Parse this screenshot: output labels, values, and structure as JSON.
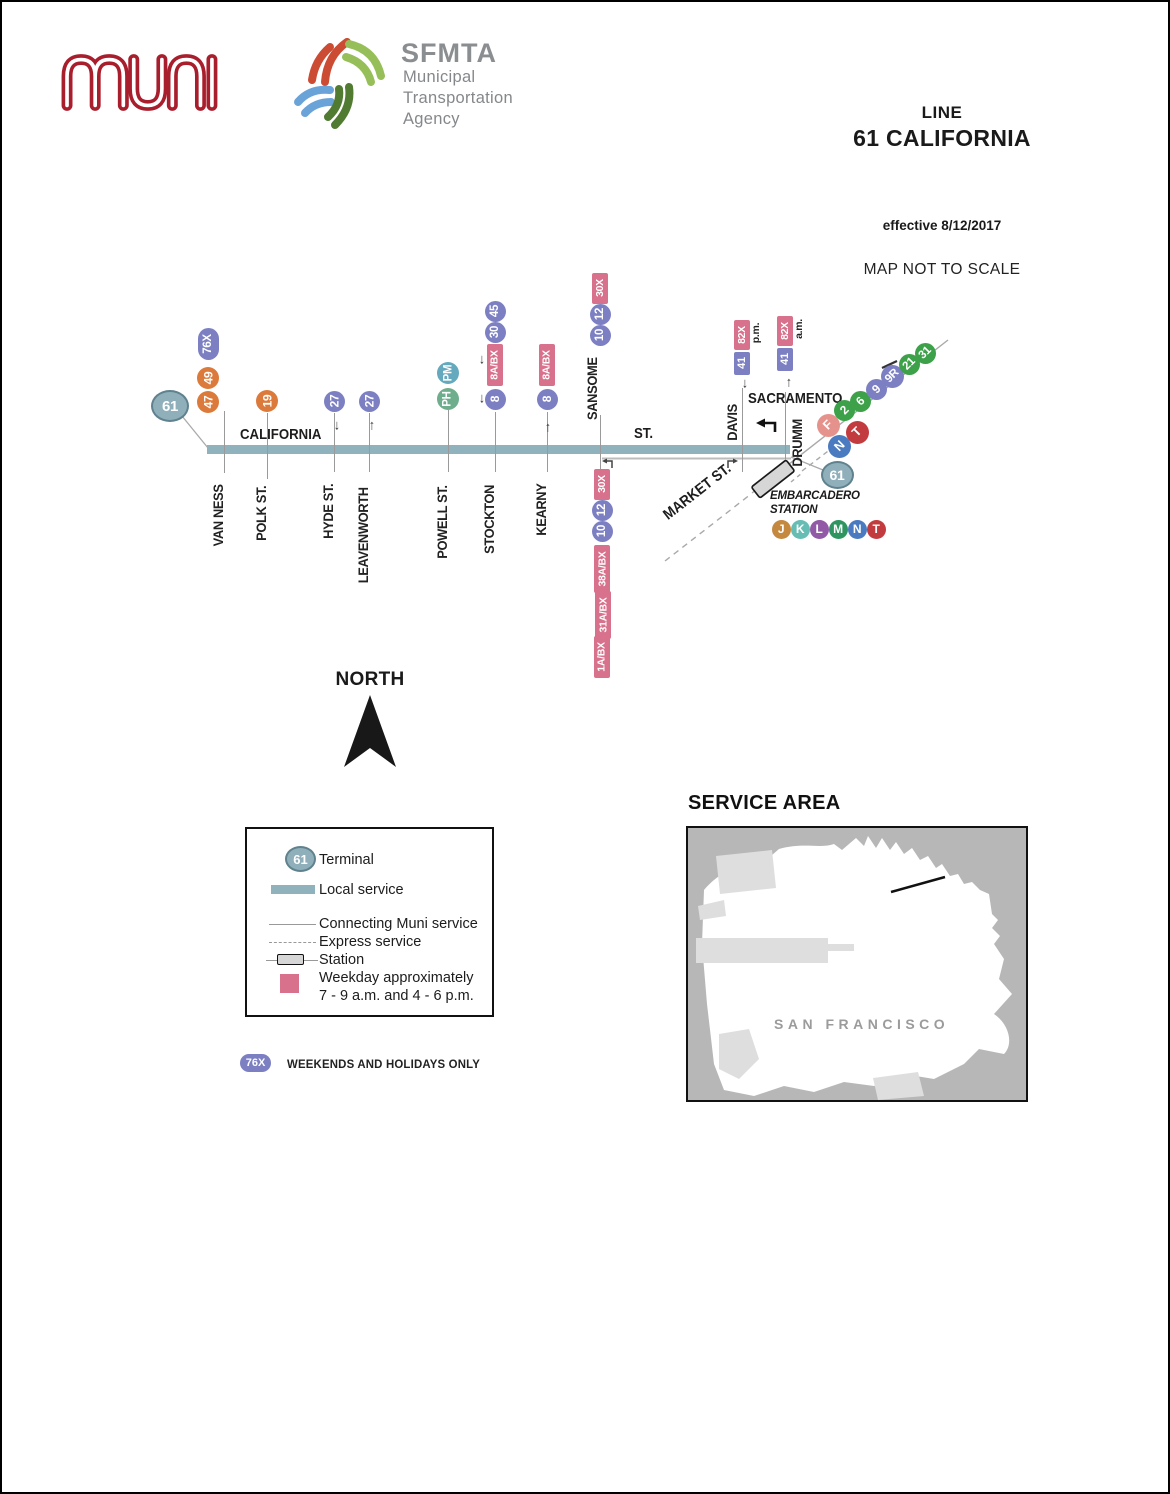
{
  "header": {
    "muni_logo": "muni",
    "sfmta": {
      "acronym": "SFMTA",
      "lines": [
        "Municipal",
        "Transportation",
        "Agency"
      ]
    },
    "line_label": "LINE",
    "line_name": "61 CALIFORNIA",
    "effective": "effective 8/12/2017",
    "scale_note": "MAP NOT TO SCALE"
  },
  "map": {
    "main_street": "CALIFORNIA",
    "main_street_suffix": "ST.",
    "cross_label_sacramento": "SACRAMENTO",
    "market_label": "MARKET ST.",
    "station_label_line1": "EMBARCADERO",
    "station_label_line2": "STATION",
    "streets": [
      {
        "label": "VAN NESS",
        "x": 222,
        "cx": 216,
        "lt": 409,
        "lb": 471,
        "ly": 477
      },
      {
        "label": "POLK ST.",
        "x": 265,
        "cx": 259,
        "lt": 411,
        "lb": 477,
        "ly": 479
      },
      {
        "label": "HYDE ST.",
        "x": 332,
        "cx": 326,
        "lt": 411,
        "lb": 470,
        "ly": 477
      },
      {
        "label": "LEAVENWORTH",
        "x": 367,
        "cx": 361,
        "lt": 411,
        "lb": 470,
        "ly": 477
      },
      {
        "label": "POWELL ST.",
        "x": 446,
        "cx": 440,
        "lt": 408,
        "lb": 470,
        "ly": 477
      },
      {
        "label": "STOCKTON",
        "x": 493,
        "cx": 487,
        "lt": 410,
        "lb": 470,
        "ly": 477
      },
      {
        "label": "KEARNY",
        "x": 545,
        "cx": 539,
        "lt": 410,
        "lb": 470,
        "ly": 477
      },
      {
        "label": "SANSOME",
        "x": 598,
        "cx": 590,
        "lt": 413,
        "lb": 470,
        "ly": 350
      },
      {
        "label": "DAVIS",
        "x": 740,
        "cx": 730,
        "lt": 386,
        "lb": 470,
        "ly": 399
      },
      {
        "label": "DRUMM",
        "x": 783,
        "cx": 795,
        "lt": 390,
        "lb": 458,
        "ly": 413
      }
    ],
    "bullets": [
      {
        "t": "61",
        "x": 168,
        "y": 404,
        "w": 38,
        "h": 32,
        "c": "terminal",
        "sh": "c",
        "r": 0,
        "fs": 15
      },
      {
        "t": "47",
        "x": 206,
        "y": 400,
        "w": 22,
        "h": 22,
        "c": "orange",
        "sh": "c",
        "r": -90,
        "fs": 12
      },
      {
        "t": "49",
        "x": 206,
        "y": 376,
        "w": 22,
        "h": 22,
        "c": "orange",
        "sh": "c",
        "r": -90,
        "fs": 12
      },
      {
        "t": "76X",
        "x": 206,
        "y": 342,
        "w": 21,
        "h": 32,
        "c": "slate",
        "sh": "p",
        "r": -90,
        "fs": 11.5
      },
      {
        "t": "19",
        "x": 265,
        "y": 399,
        "w": 22,
        "h": 22,
        "c": "orange",
        "sh": "c",
        "r": -90,
        "fs": 12
      },
      {
        "t": "27",
        "x": 332,
        "y": 399,
        "w": 21,
        "h": 21,
        "c": "slate",
        "sh": "c",
        "r": -90,
        "fs": 12
      },
      {
        "t": "27",
        "x": 367,
        "y": 399,
        "w": 21,
        "h": 21,
        "c": "slate",
        "sh": "c",
        "r": -90,
        "fs": 12
      },
      {
        "t": "PH",
        "x": 446,
        "y": 397,
        "w": 22,
        "h": 22,
        "c": "phgreen",
        "sh": "c",
        "r": -90,
        "fs": 11.5
      },
      {
        "t": "PM",
        "x": 446,
        "y": 371,
        "w": 22,
        "h": 22,
        "c": "pmteal",
        "sh": "c",
        "r": -90,
        "fs": 11.5
      },
      {
        "t": "8",
        "x": 493,
        "y": 397,
        "w": 21,
        "h": 21,
        "c": "slate",
        "sh": "c",
        "r": -90,
        "fs": 12
      },
      {
        "t": "8A/BX",
        "x": 493,
        "y": 363,
        "w": 16,
        "h": 42,
        "c": "pink",
        "sh": "rct",
        "r": -90,
        "fs": 10.5
      },
      {
        "t": "30",
        "x": 493,
        "y": 330,
        "w": 21,
        "h": 21,
        "c": "slate",
        "sh": "c",
        "r": -90,
        "fs": 11.5
      },
      {
        "t": "45",
        "x": 493,
        "y": 309,
        "w": 21,
        "h": 21,
        "c": "slate",
        "sh": "c",
        "r": -90,
        "fs": 11.5
      },
      {
        "t": "8",
        "x": 545,
        "y": 397,
        "w": 21,
        "h": 21,
        "c": "slate",
        "sh": "c",
        "r": -90,
        "fs": 12
      },
      {
        "t": "8A/BX",
        "x": 545,
        "y": 363,
        "w": 16,
        "h": 42,
        "c": "pink",
        "sh": "rct",
        "r": -90,
        "fs": 10.5
      },
      {
        "t": "10",
        "x": 598,
        "y": 333,
        "w": 21,
        "h": 21,
        "c": "slate",
        "sh": "c",
        "r": -90,
        "fs": 11.5
      },
      {
        "t": "12",
        "x": 598,
        "y": 312,
        "w": 21,
        "h": 21,
        "c": "slate",
        "sh": "c",
        "r": -90,
        "fs": 11.5
      },
      {
        "t": "30X",
        "x": 598,
        "y": 286,
        "w": 16,
        "h": 31,
        "c": "pink",
        "sh": "rct",
        "r": -90,
        "fs": 10.5
      },
      {
        "t": "30X",
        "x": 600,
        "y": 482,
        "w": 16,
        "h": 31,
        "c": "pink",
        "sh": "rct",
        "r": -90,
        "fs": 10.5
      },
      {
        "t": "12",
        "x": 600,
        "y": 508,
        "w": 21,
        "h": 21,
        "c": "slate",
        "sh": "c",
        "r": -90,
        "fs": 11.5
      },
      {
        "t": "10",
        "x": 600,
        "y": 529,
        "w": 21,
        "h": 21,
        "c": "slate",
        "sh": "c",
        "r": -90,
        "fs": 11.5
      },
      {
        "t": "38A/BX",
        "x": 600,
        "y": 567,
        "w": 16,
        "h": 48,
        "c": "pink",
        "sh": "rct",
        "r": -90,
        "fs": 10.5
      },
      {
        "t": "31A/BX",
        "x": 601,
        "y": 613,
        "w": 16,
        "h": 48,
        "c": "pink",
        "sh": "rct",
        "r": -90,
        "fs": 10.5
      },
      {
        "t": "1A/BX",
        "x": 600,
        "y": 655,
        "w": 16,
        "h": 42,
        "c": "pink",
        "sh": "rct",
        "r": -90,
        "fs": 10.5
      },
      {
        "t": "41",
        "x": 740,
        "y": 361,
        "w": 16,
        "h": 23,
        "c": "slate",
        "sh": "rct",
        "r": -90,
        "fs": 11
      },
      {
        "t": "82X",
        "x": 740,
        "y": 333,
        "w": 16,
        "h": 30,
        "c": "pink",
        "sh": "rct",
        "r": -90,
        "fs": 10.5
      },
      {
        "t": "p.m.",
        "x": 754,
        "y": 331,
        "w": 12,
        "h": 26,
        "c": "lbl",
        "sh": "t",
        "r": -90,
        "fs": 10.5
      },
      {
        "t": "41",
        "x": 783,
        "y": 357,
        "w": 16,
        "h": 23,
        "c": "slate",
        "sh": "rct",
        "r": -90,
        "fs": 11
      },
      {
        "t": "82X",
        "x": 783,
        "y": 329,
        "w": 16,
        "h": 30,
        "c": "pink",
        "sh": "rct",
        "r": -90,
        "fs": 10.5
      },
      {
        "t": "a.m.",
        "x": 797,
        "y": 327,
        "w": 12,
        "h": 26,
        "c": "lbl",
        "sh": "t",
        "r": -90,
        "fs": 10.5
      },
      {
        "t": "F",
        "x": 826,
        "y": 423,
        "w": 23,
        "h": 23,
        "c": "salmon",
        "sh": "c",
        "r": -45,
        "fs": 12.5
      },
      {
        "t": "N",
        "x": 837,
        "y": 444,
        "w": 23,
        "h": 23,
        "c": "blue",
        "sh": "c",
        "r": -45,
        "fs": 12.5
      },
      {
        "t": "T",
        "x": 855,
        "y": 430,
        "w": 23,
        "h": 23,
        "c": "red",
        "sh": "c",
        "r": -45,
        "fs": 12.5
      },
      {
        "t": "2",
        "x": 842,
        "y": 408,
        "w": 21,
        "h": 21,
        "c": "green",
        "sh": "c",
        "r": -45,
        "fs": 12
      },
      {
        "t": "6",
        "x": 858,
        "y": 399,
        "w": 21,
        "h": 21,
        "c": "green",
        "sh": "c",
        "r": -45,
        "fs": 12
      },
      {
        "t": "9",
        "x": 874,
        "y": 387,
        "w": 21,
        "h": 21,
        "c": "slate",
        "sh": "c",
        "r": -45,
        "fs": 12
      },
      {
        "t": "9R",
        "x": 890,
        "y": 374,
        "w": 23,
        "h": 23,
        "c": "slate",
        "sh": "c",
        "r": -45,
        "fs": 11.5
      },
      {
        "t": "21",
        "x": 907,
        "y": 362,
        "w": 21,
        "h": 21,
        "c": "green",
        "sh": "c",
        "r": -45,
        "fs": 11.5
      },
      {
        "t": "31",
        "x": 923,
        "y": 351,
        "w": 21,
        "h": 21,
        "c": "green",
        "sh": "c",
        "r": -45,
        "fs": 11.5
      },
      {
        "t": "61",
        "x": 835,
        "y": 473,
        "w": 33,
        "h": 28,
        "c": "terminal",
        "sh": "c",
        "r": 0,
        "fs": 14
      },
      {
        "t": "J",
        "x": 779,
        "y": 527,
        "w": 19,
        "h": 19,
        "c": "bronze",
        "sh": "c",
        "r": 0,
        "fs": 12
      },
      {
        "t": "K",
        "x": 798,
        "y": 527,
        "w": 19,
        "h": 19,
        "c": "kteal",
        "sh": "c",
        "r": 0,
        "fs": 12
      },
      {
        "t": "L",
        "x": 817,
        "y": 527,
        "w": 19,
        "h": 19,
        "c": "violet",
        "sh": "c",
        "r": 0,
        "fs": 12
      },
      {
        "t": "M",
        "x": 836,
        "y": 527,
        "w": 19,
        "h": 19,
        "c": "mgreen",
        "sh": "c",
        "r": 0,
        "fs": 12
      },
      {
        "t": "N",
        "x": 855,
        "y": 527,
        "w": 19,
        "h": 19,
        "c": "blue",
        "sh": "c",
        "r": 0,
        "fs": 12
      },
      {
        "t": "T",
        "x": 874,
        "y": 527,
        "w": 19,
        "h": 19,
        "c": "red",
        "sh": "c",
        "r": 0,
        "fs": 12
      }
    ],
    "arrows": [
      {
        "g": "↓",
        "x": 337,
        "y": 423
      },
      {
        "g": "↑",
        "x": 372,
        "y": 423
      },
      {
        "g": "↓",
        "x": 482,
        "y": 357
      },
      {
        "g": "↓",
        "x": 482,
        "y": 396
      },
      {
        "g": "↑",
        "x": 548,
        "y": 425
      },
      {
        "g": "↓",
        "x": 745,
        "y": 381
      },
      {
        "g": "↑",
        "x": 789,
        "y": 380
      }
    ]
  },
  "north": {
    "label": "NORTH"
  },
  "legend": {
    "terminal_bullet": "61",
    "terminal": "Terminal",
    "local": "Local service",
    "connecting": "Connecting Muni service",
    "express": "Express service",
    "station": "Station",
    "weekday_line1": "Weekday approximately",
    "weekday_line2": "7 - 9 a.m. and 4 - 6 p.m."
  },
  "footnote": {
    "bullet": "76X",
    "text": "WEEKENDS AND HOLIDAYS ONLY"
  },
  "service_area": {
    "title": "SERVICE AREA",
    "city_label": "SAN FRANCISCO"
  },
  "colors": {
    "local_line": "#8FB2BC",
    "orange": "#DB7A3A",
    "slate_purple": "#7C80C3",
    "weekday_pink": "#D8718C",
    "ph_green": "#6FAE8C",
    "pm_teal": "#64A9BD",
    "green": "#3DA14A",
    "salmon_f": "#E6928C",
    "metro_blue": "#4A7ABF",
    "metro_red": "#C23B3E",
    "metro_bronze": "#C4883F",
    "metro_teal": "#66BDB3",
    "metro_violet": "#9159A6",
    "metro_green": "#2E9560",
    "terminal_fill": "#8FAFBA",
    "muni_red": "#A81E2C"
  }
}
